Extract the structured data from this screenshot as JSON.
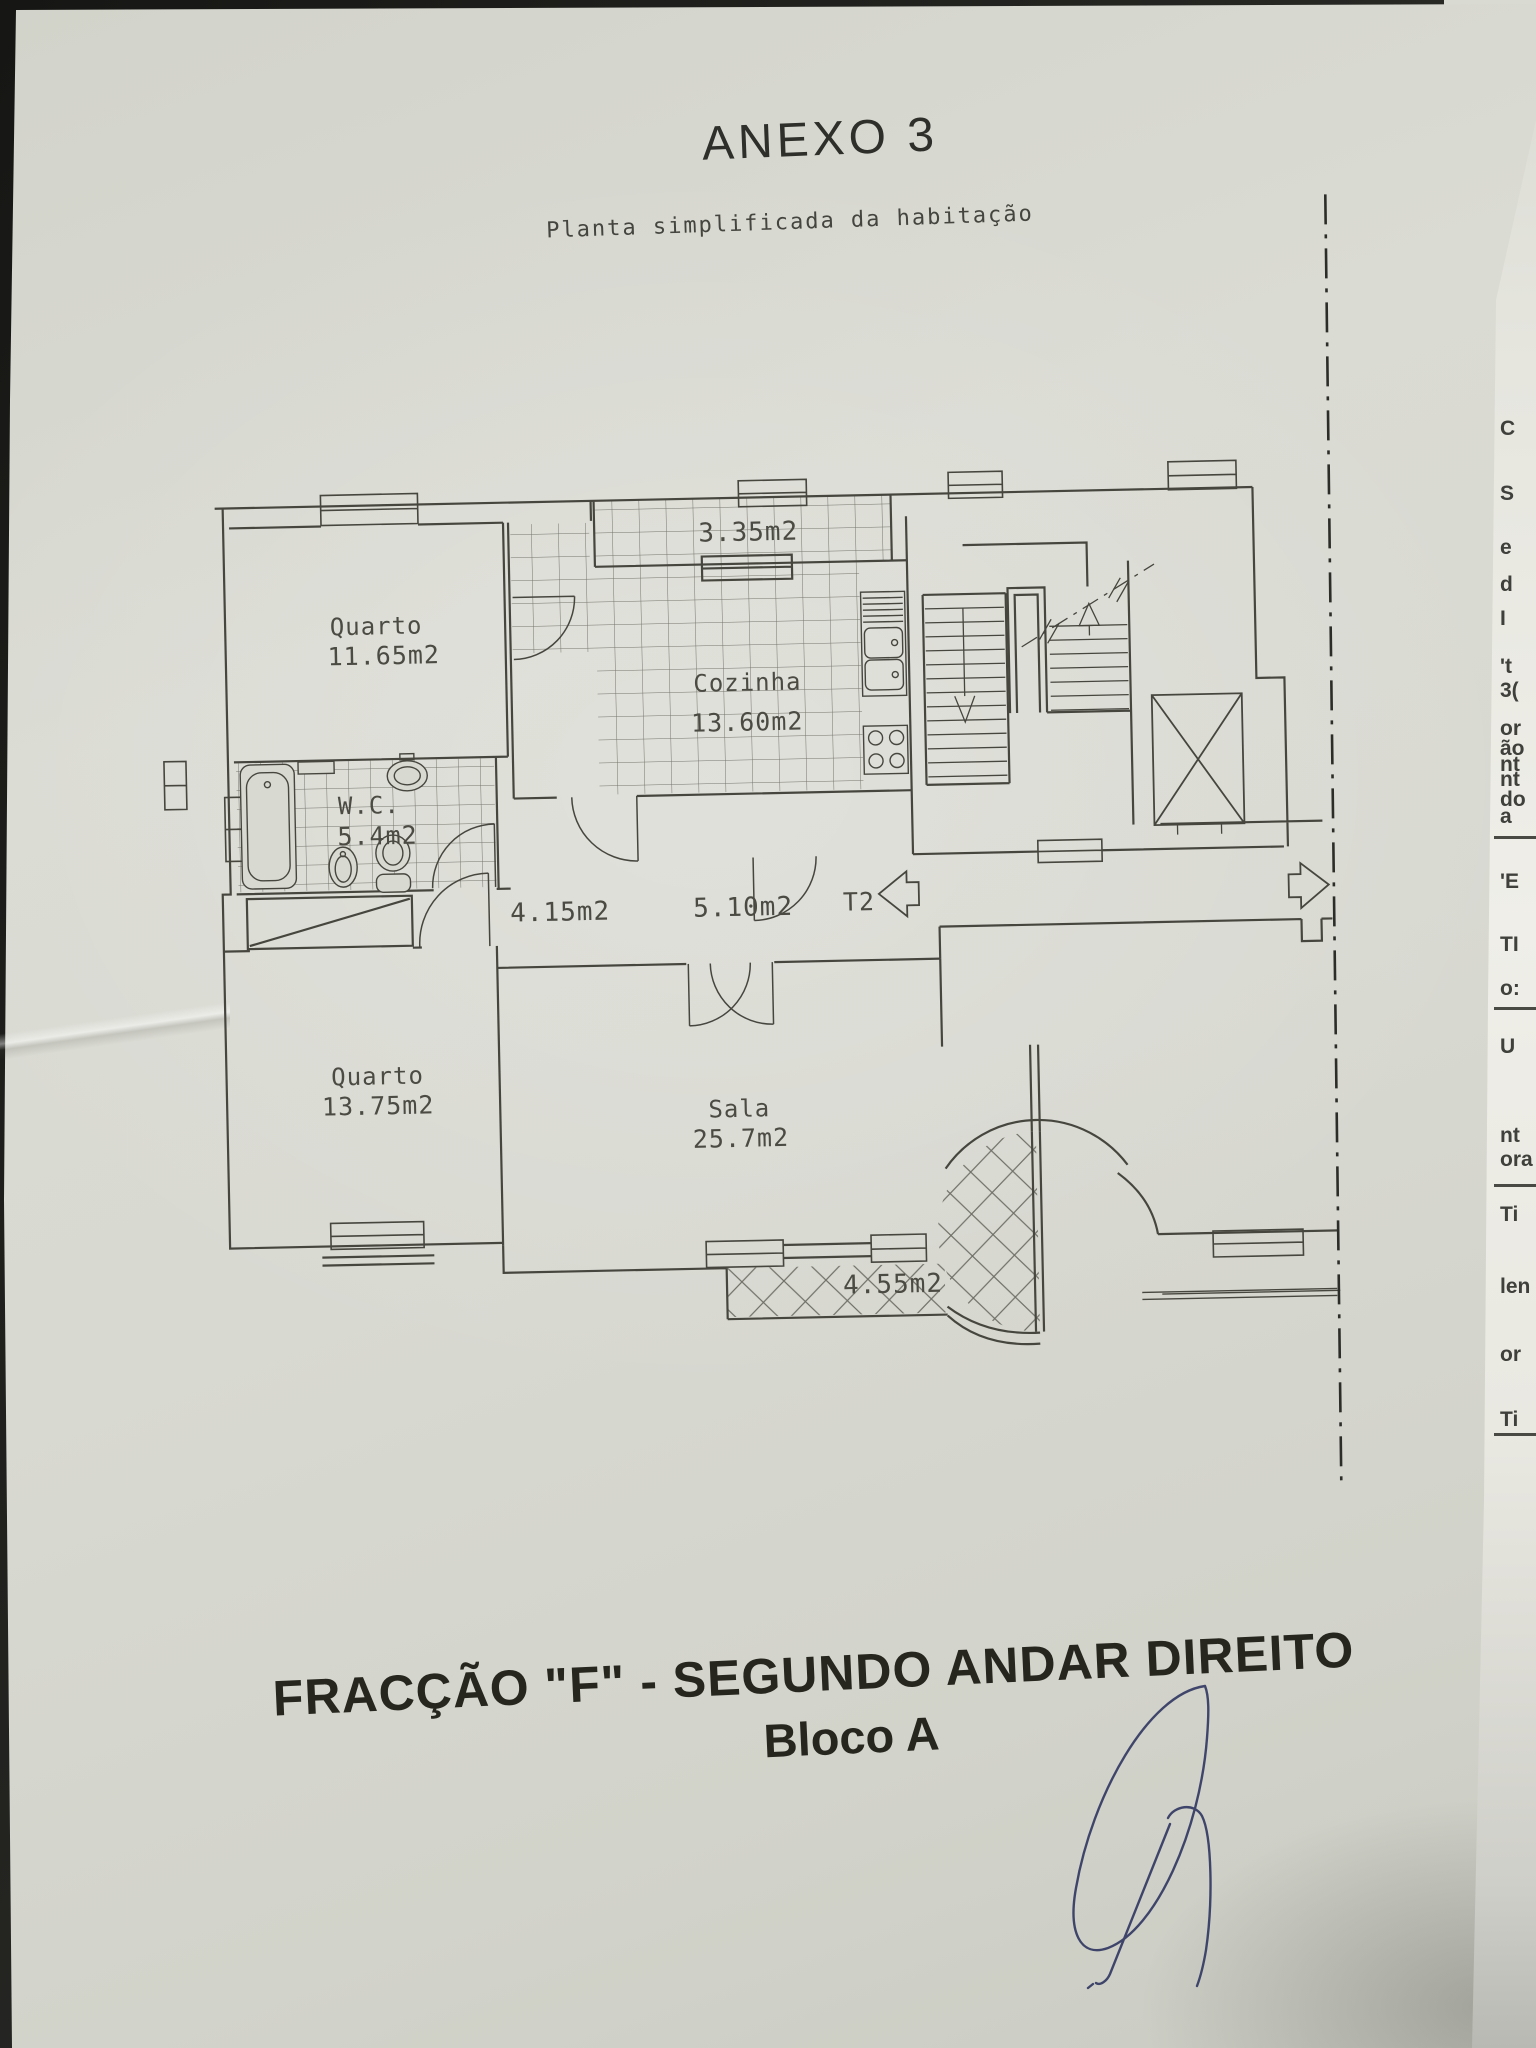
{
  "document": {
    "title": "ANEXO 3",
    "subtitle": "Planta simplificada da habitação",
    "caption_line1": "FRACÇÃO  \"F\" - SEGUNDO ANDAR DIREITO",
    "caption_line2": "Bloco A"
  },
  "plan": {
    "unit_label": "T2",
    "labels": {
      "balcony_top_area": "3.35m2",
      "quarto1_name": "Quarto",
      "quarto1_area": "11.65m2",
      "cozinha_name": "Cozinha",
      "cozinha_area": "13.60m2",
      "wc_name": "W.C.",
      "wc_area": "5.4m2",
      "hall_area": "4.15m2",
      "corridor_area": "5.10m2",
      "quarto2_name": "Quarto",
      "quarto2_area": "13.75m2",
      "sala_name": "Sala",
      "sala_area": "25.7m2",
      "balcony_bottom_area": "4.55m2"
    }
  },
  "edge_fragments": [
    {
      "top": 417,
      "text": "C"
    },
    {
      "top": 482,
      "text": "S"
    },
    {
      "top": 536,
      "text": "e"
    },
    {
      "top": 573,
      "text": "d"
    },
    {
      "top": 607,
      "text": "I"
    },
    {
      "top": 655,
      "text": "'t"
    },
    {
      "top": 679,
      "text": "3("
    },
    {
      "top": 717,
      "text": "or"
    },
    {
      "top": 737,
      "text": "ão"
    },
    {
      "top": 753,
      "text": "nt"
    },
    {
      "top": 768,
      "text": "nt"
    },
    {
      "top": 788,
      "text": "do"
    },
    {
      "top": 805,
      "text": "a"
    },
    {
      "top": 870,
      "text": "'E"
    },
    {
      "top": 933,
      "text": "TI"
    },
    {
      "top": 977,
      "text": "o:"
    },
    {
      "top": 1035,
      "text": "U"
    },
    {
      "top": 1124,
      "text": "nt"
    },
    {
      "top": 1148,
      "text": "ora"
    },
    {
      "top": 1203,
      "text": "Ti"
    },
    {
      "top": 1275,
      "text": "len"
    },
    {
      "top": 1343,
      "text": "or"
    },
    {
      "top": 1408,
      "text": "Ti"
    }
  ],
  "edge_rules": [
    {
      "top": 836
    },
    {
      "top": 1007
    },
    {
      "top": 1184
    },
    {
      "top": 1433
    }
  ],
  "colors": {
    "paper": "#d7d8cf",
    "plan_ink": "#46463f",
    "title_ink": "#2e2e2a",
    "signature_ink": "#333a63",
    "scan_background": "#1e1e1c"
  }
}
